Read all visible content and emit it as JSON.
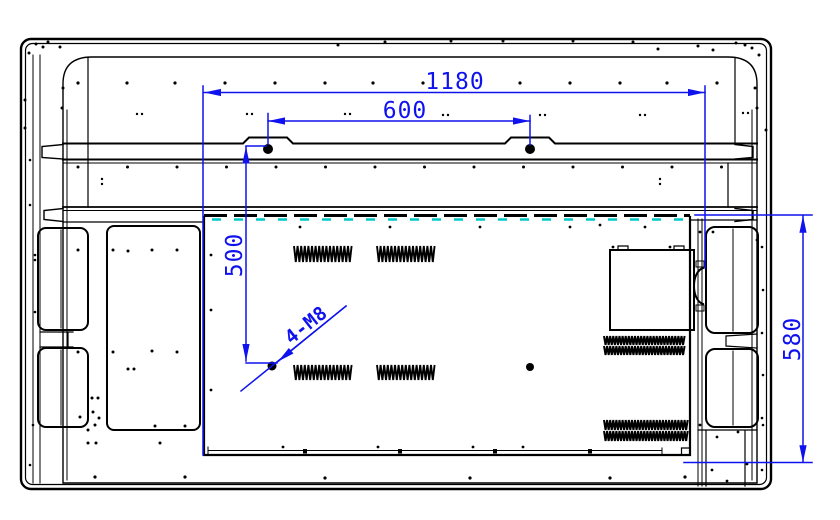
{
  "drawing": {
    "description": "Rear-view engineering drawing of a flat panel display showing wall-mount hole pattern and overall dimensions",
    "dimensions": [
      {
        "id": "overall-width",
        "value": "1180",
        "orientation": "horizontal"
      },
      {
        "id": "mount-hole-spacing-horizontal",
        "value": "600",
        "orientation": "horizontal"
      },
      {
        "id": "mount-hole-spacing-vertical",
        "value": "500",
        "orientation": "vertical"
      },
      {
        "id": "panel-height",
        "value": "580",
        "orientation": "vertical"
      },
      {
        "id": "thread-callout",
        "value": "4-M8",
        "orientation": "angled-leader"
      }
    ],
    "colors": {
      "line": "#000000",
      "dimension": "#0f12ee",
      "vent_dash": "#00c8c8",
      "background": "#ffffff"
    }
  }
}
